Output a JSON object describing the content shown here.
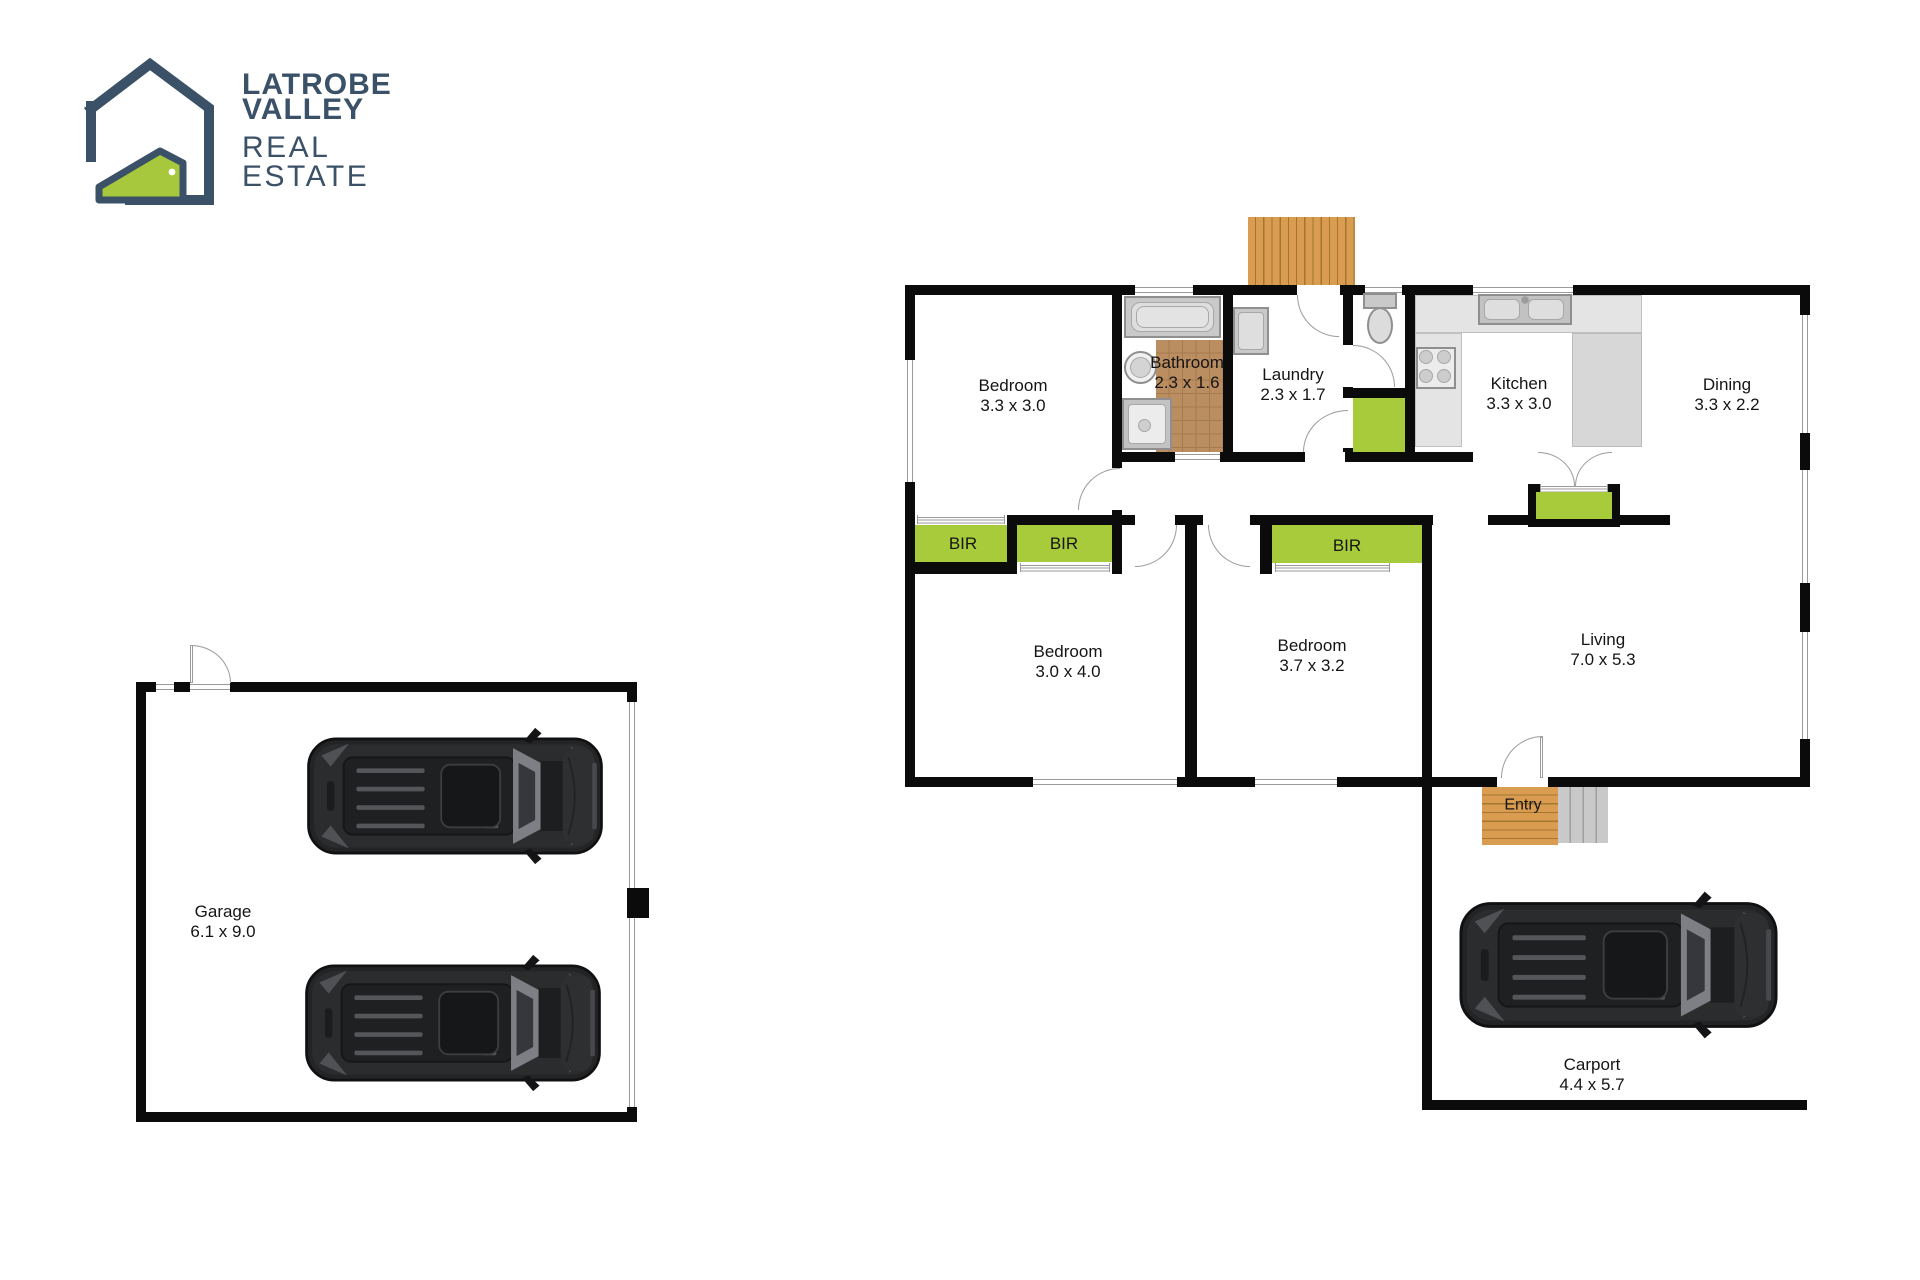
{
  "logo": {
    "line1": "LATROBE",
    "line2": "VALLEY",
    "line3": "REAL",
    "line4": "ESTATE"
  },
  "colors": {
    "navy": "#3a5168",
    "brandGreen": "#a7c83d",
    "wall": "#0b0b0b",
    "robe": "#a8cb3c",
    "deck": "#d99c51",
    "deckLine": "#a4762f",
    "tile": "#bb8e61",
    "tileLine": "#a57a4c",
    "step": "#c9c9c9",
    "stepLine": "#9f9f9f",
    "carBody": "#2b2c2e"
  },
  "rooms": {
    "bedroom1": {
      "name": "Bedroom",
      "dims": "3.3 x 3.0"
    },
    "bathroom": {
      "name": "Bathroom",
      "dims": "2.3 x 1.6"
    },
    "laundry": {
      "name": "Laundry",
      "dims": "2.3 x 1.7"
    },
    "kitchen": {
      "name": "Kitchen",
      "dims": "3.3 x 3.0"
    },
    "dining": {
      "name": "Dining",
      "dims": "3.3 x 2.2"
    },
    "bedroom2": {
      "name": "Bedroom",
      "dims": "3.0 x 4.0"
    },
    "bedroom3": {
      "name": "Bedroom",
      "dims": "3.7 x 3.2"
    },
    "living": {
      "name": "Living",
      "dims": "7.0 x 5.3"
    },
    "entry": {
      "name": "Entry"
    },
    "carport": {
      "name": "Carport",
      "dims": "4.4 x 5.7"
    },
    "garage": {
      "name": "Garage",
      "dims": "6.1 x 9.0"
    }
  },
  "closets": {
    "bir1": "BIR",
    "bir2": "BIR",
    "bir3": "BIR"
  }
}
